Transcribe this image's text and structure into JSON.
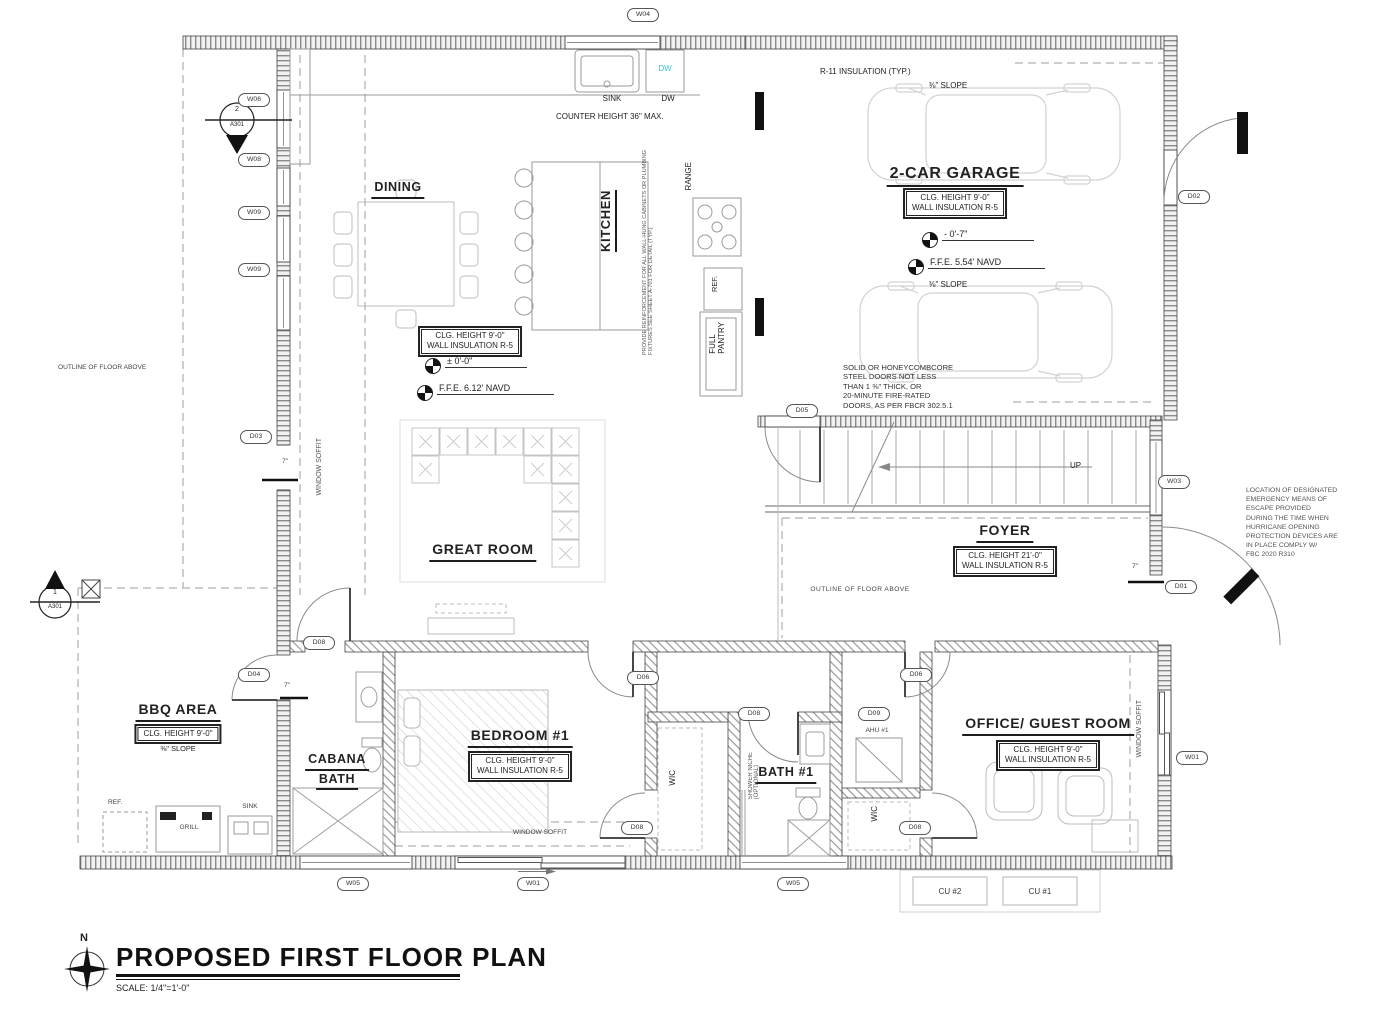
{
  "title_block": {
    "north_label": "N",
    "title": "PROPOSED FIRST FLOOR PLAN",
    "scale": "SCALE:  1/4\"=1'-0\""
  },
  "rooms": {
    "dining": {
      "name": "DINING"
    },
    "kitchen": {
      "name": "KITCHEN"
    },
    "great_room": {
      "name": "GREAT ROOM",
      "clg": "CLG. HEIGHT 9'-0\"",
      "ins": "WALL INSULATION R-5",
      "elev_rel": "± 0'-0\"",
      "elev_ffe": "F.F.E.  6.12' NAVD"
    },
    "garage": {
      "name": "2-CAR GARAGE",
      "clg": "CLG. HEIGHT 9'-0\"",
      "ins": "WALL INSULATION R-5",
      "elev_rel": "- 0'-7\"",
      "elev_ffe": "F.F.E.  5.54' NAVD",
      "slope_top": "⅜\" SLOPE",
      "slope_bottom": "⅜\" SLOPE",
      "insulation": "R-11 INSULATION (TYP.)"
    },
    "foyer": {
      "name": "FOYER",
      "clg": "CLG. HEIGHT 21'-0\"",
      "ins": "WALL INSULATION R-5"
    },
    "bedroom1": {
      "name": "BEDROOM #1",
      "clg": "CLG. HEIGHT 9'-0\"",
      "ins": "WALL INSULATION R-5"
    },
    "cabana_bath": {
      "name_line1": "CABANA",
      "name_line2": "BATH"
    },
    "bath1": {
      "name": "BATH #1",
      "shower_note": "SHOWER NICHE\n(OPTIONAL)"
    },
    "wic_bedroom": {
      "name": "WIC"
    },
    "wic_bath": {
      "name": "WIC"
    },
    "ahu": {
      "name": "AHU #1"
    },
    "office": {
      "name": "OFFICE/ GUEST ROOM",
      "clg": "CLG. HEIGHT 9'-0\"",
      "ins": "WALL INSULATION R-5"
    },
    "bbq": {
      "name": "BBQ AREA",
      "clg": "CLG. HEIGHT 9'-0\"",
      "slope": "⅜\" SLOPE",
      "ref": "REF.",
      "grill": "GRILL",
      "sink": "SINK"
    }
  },
  "kitchen_items": {
    "sink": "SINK",
    "dw": "DW",
    "dw_unit": "DW",
    "counter_note": "COUNTER HEIGHT 36\"  MAX.",
    "range": "RANGE",
    "ref": "REF.",
    "pantry": "FULL\nPANTRY",
    "reinforce_note": "PROVIDE REINFORCEMENT FOR ALL WALL-HUNG CABINETS OR PLUMBING\nFIXTURES SEE SHEET A-701 FOR DETAIL (TYP.)"
  },
  "stairs": {
    "up": "UP"
  },
  "notes": {
    "steel_doors": "SOLID OR HONEYCOMBCORE\nSTEEL DOORS NOT LESS\nTHAN 1 ⅜\" THICK, OR\n20-MINUTE FIRE-RATED\nDOORS, AS PER FBCR 302.5.1",
    "emergency": "LOCATION OF DESIGNATED\nEMERGENCY MEANS OF\nESCAPE PROVIDED\nDURING THE TIME WHEN\nHURRICANE OPENING\nPROTECTION DEVICES ARE\nIN PLACE COMPLY W/\nFBC 2020 R310",
    "outline_left": "OUTLINE OF FLOOR ABOVE",
    "outline_foyer": "OUTLINE OF FLOOR ABOVE",
    "soffit_left": "WINDOW SOFFIT",
    "soffit_bedroom": "WINDOW SOFFIT",
    "soffit_office": "WINDOW SOFFIT"
  },
  "dims": {
    "jamb_left": "7\"",
    "jamb_cabana": "7\"",
    "jamb_entry": "7\""
  },
  "equipment": {
    "cu2": "CU #2",
    "cu1": "CU #1"
  },
  "section_markers": {
    "top": {
      "num": "2",
      "sheet": "A301"
    },
    "left": {
      "num": "1",
      "sheet": "A301"
    }
  },
  "tags": [
    {
      "label": "W04"
    },
    {
      "label": "W06"
    },
    {
      "label": "W08"
    },
    {
      "label": "W09"
    },
    {
      "label": "W09"
    },
    {
      "label": "D02"
    },
    {
      "label": "D03"
    },
    {
      "label": "D05"
    },
    {
      "label": "W03"
    },
    {
      "label": "D01"
    },
    {
      "label": "D04"
    },
    {
      "label": "D08"
    },
    {
      "label": "D06"
    },
    {
      "label": "D08"
    },
    {
      "label": "D09"
    },
    {
      "label": "D06"
    },
    {
      "label": "D08"
    },
    {
      "label": "D08"
    },
    {
      "label": "W01"
    },
    {
      "label": "W05"
    },
    {
      "label": "W01"
    },
    {
      "label": "W05"
    }
  ],
  "colors": {
    "accent_dw": "#3ec6d6",
    "ink": "#333333"
  }
}
